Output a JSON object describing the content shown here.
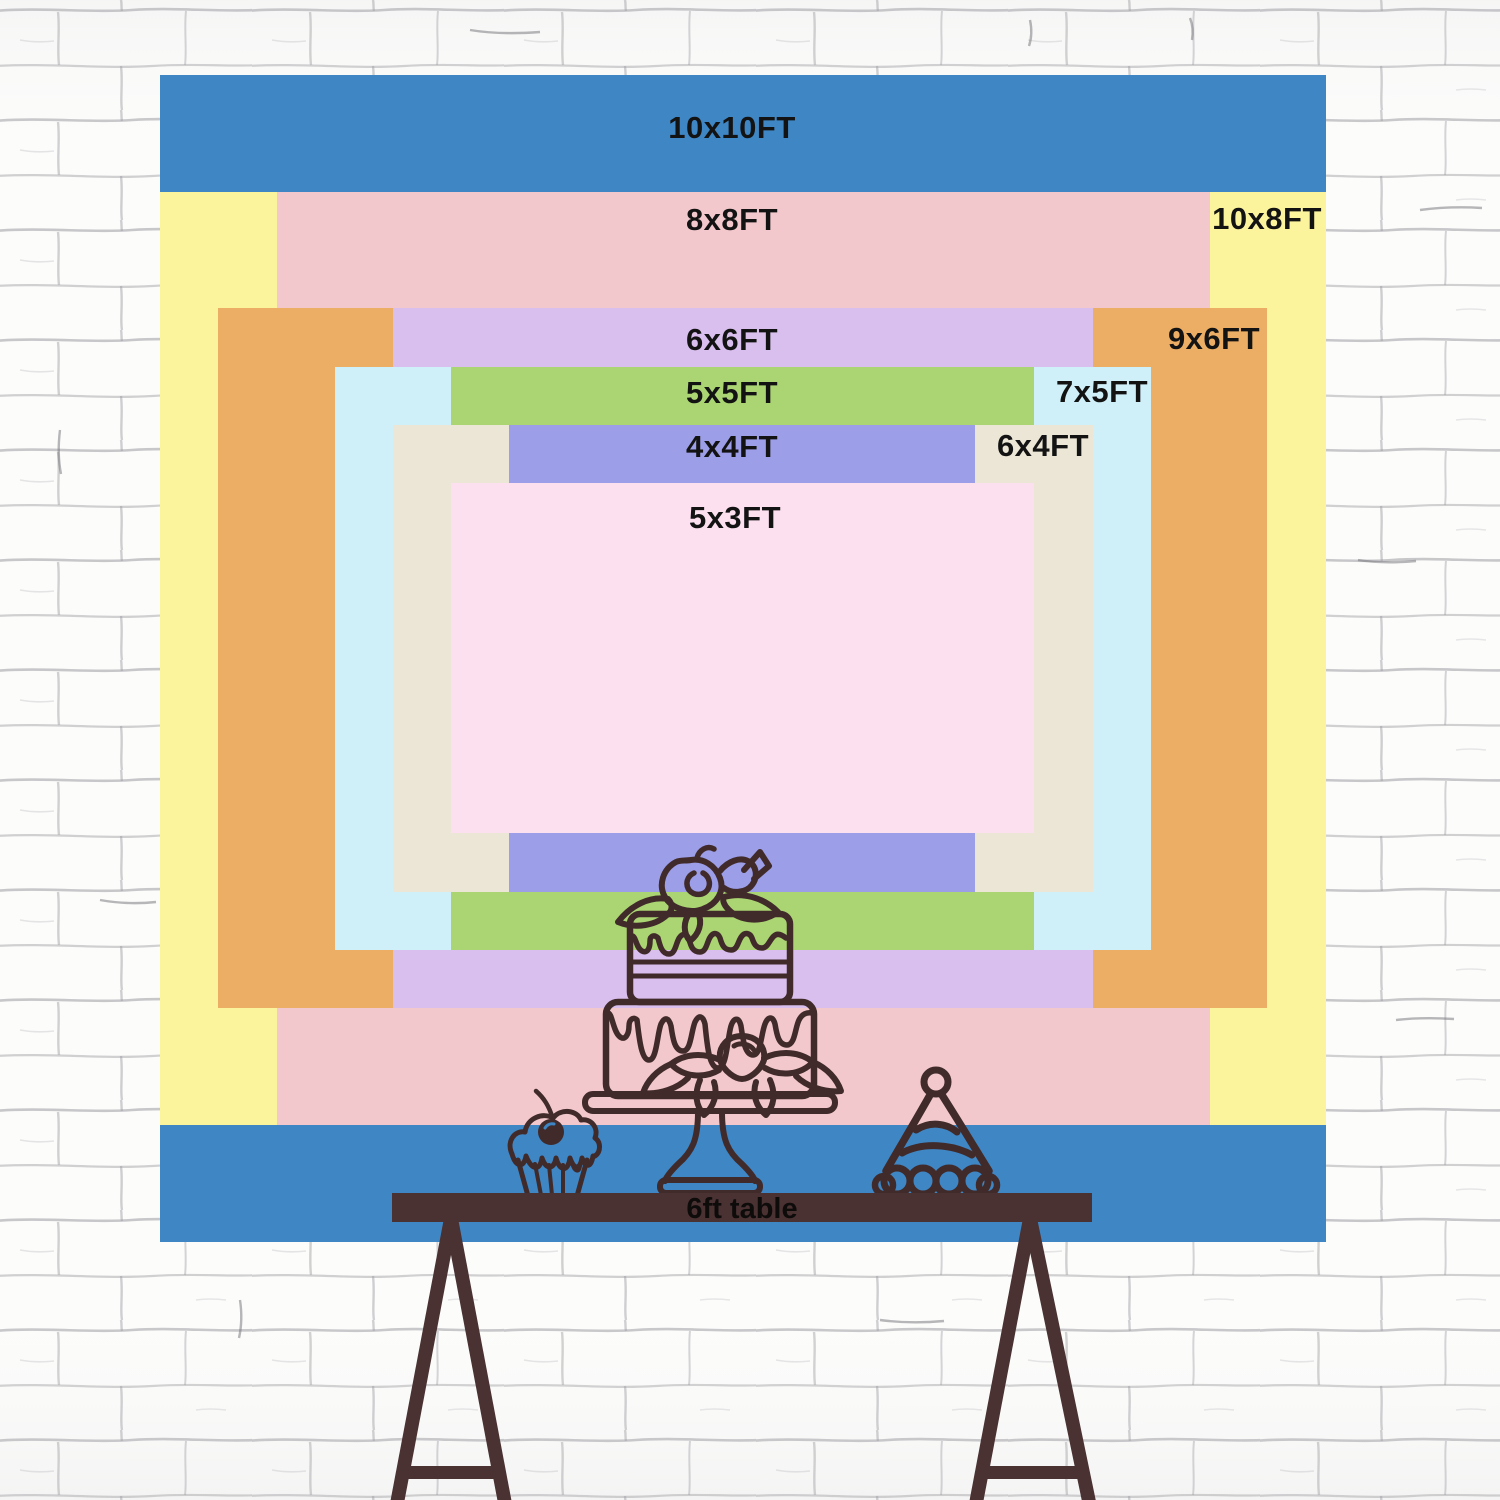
{
  "title": "Backdrop size comparison chart",
  "sizes": [
    {
      "label": "10x10FT",
      "width_ft": 10,
      "height_ft": 10,
      "color": "#3F86C4"
    },
    {
      "label": "10x8FT",
      "width_ft": 10,
      "height_ft": 8,
      "color": "#FCF49D"
    },
    {
      "label": "8x8FT",
      "width_ft": 8,
      "height_ft": 8,
      "color": "#F2C8CC"
    },
    {
      "label": "9x6FT",
      "width_ft": 9,
      "height_ft": 6,
      "color": "#ECAE64"
    },
    {
      "label": "6x6FT",
      "width_ft": 6,
      "height_ft": 6,
      "color": "#D9BFED"
    },
    {
      "label": "7x5FT",
      "width_ft": 7,
      "height_ft": 5,
      "color": "#CFEFF9"
    },
    {
      "label": "5x5FT",
      "width_ft": 5,
      "height_ft": 5,
      "color": "#AAD572"
    },
    {
      "label": "6x4FT",
      "width_ft": 6,
      "height_ft": 4,
      "color": "#EBE6D6"
    },
    {
      "label": "4x4FT",
      "width_ft": 4,
      "height_ft": 4,
      "color": "#9C9EE8"
    },
    {
      "label": "5x3FT",
      "width_ft": 5,
      "height_ft": 3,
      "color": "#FDE0F0"
    }
  ],
  "table": {
    "label": "6ft table"
  },
  "artwork": {
    "items": [
      "cupcake line drawing",
      "two-tier cake on stand line drawing",
      "party hat line drawing",
      "trestle table"
    ]
  },
  "colors": {
    "ink": "#402A2A",
    "table_wood": "#4A3132",
    "label_text": "#131313",
    "table_text": "#0E0B0B",
    "wall_bg": "#FCFCFB",
    "mortar": "#A0A0A6",
    "cherry_highlight": "#3E85C4"
  }
}
